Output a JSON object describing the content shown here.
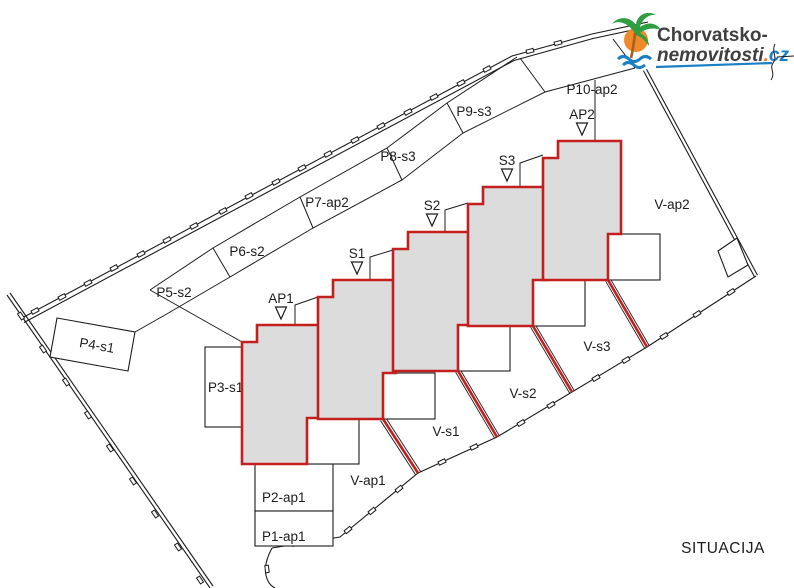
{
  "drawing": {
    "title": "SITUACIJA"
  },
  "logo": {
    "line1": "Chorvatsko-",
    "line2": "nemovitosti",
    "dot": ".",
    "tld": "cz"
  },
  "parking_spots": [
    "P1-ap1",
    "P2-ap1",
    "P3-s1",
    "P4-s1",
    "P5-s2",
    "P6-s2",
    "P7-ap2",
    "P8-s3",
    "P9-s3",
    "P10-ap2"
  ],
  "units": [
    "AP1",
    "S1",
    "S2",
    "S3",
    "AP2"
  ],
  "gardens": [
    "V-ap1",
    "V-s1",
    "V-s2",
    "V-s3",
    "V-ap2"
  ],
  "icons": {
    "palm": "palm-tree-logo-icon",
    "tick": "survey-tick-mark",
    "unit_marker": "triangle-down-marker"
  },
  "colors": {
    "outline_red": "#c21f1f",
    "building_fill": "#dcdcdc",
    "line_black": "#1c1c1c",
    "logo_dark": "#3f3f3f",
    "logo_blue": "#1b7fc4",
    "logo_orange": "#ed7d31",
    "logo_green": "#2f9e41"
  }
}
